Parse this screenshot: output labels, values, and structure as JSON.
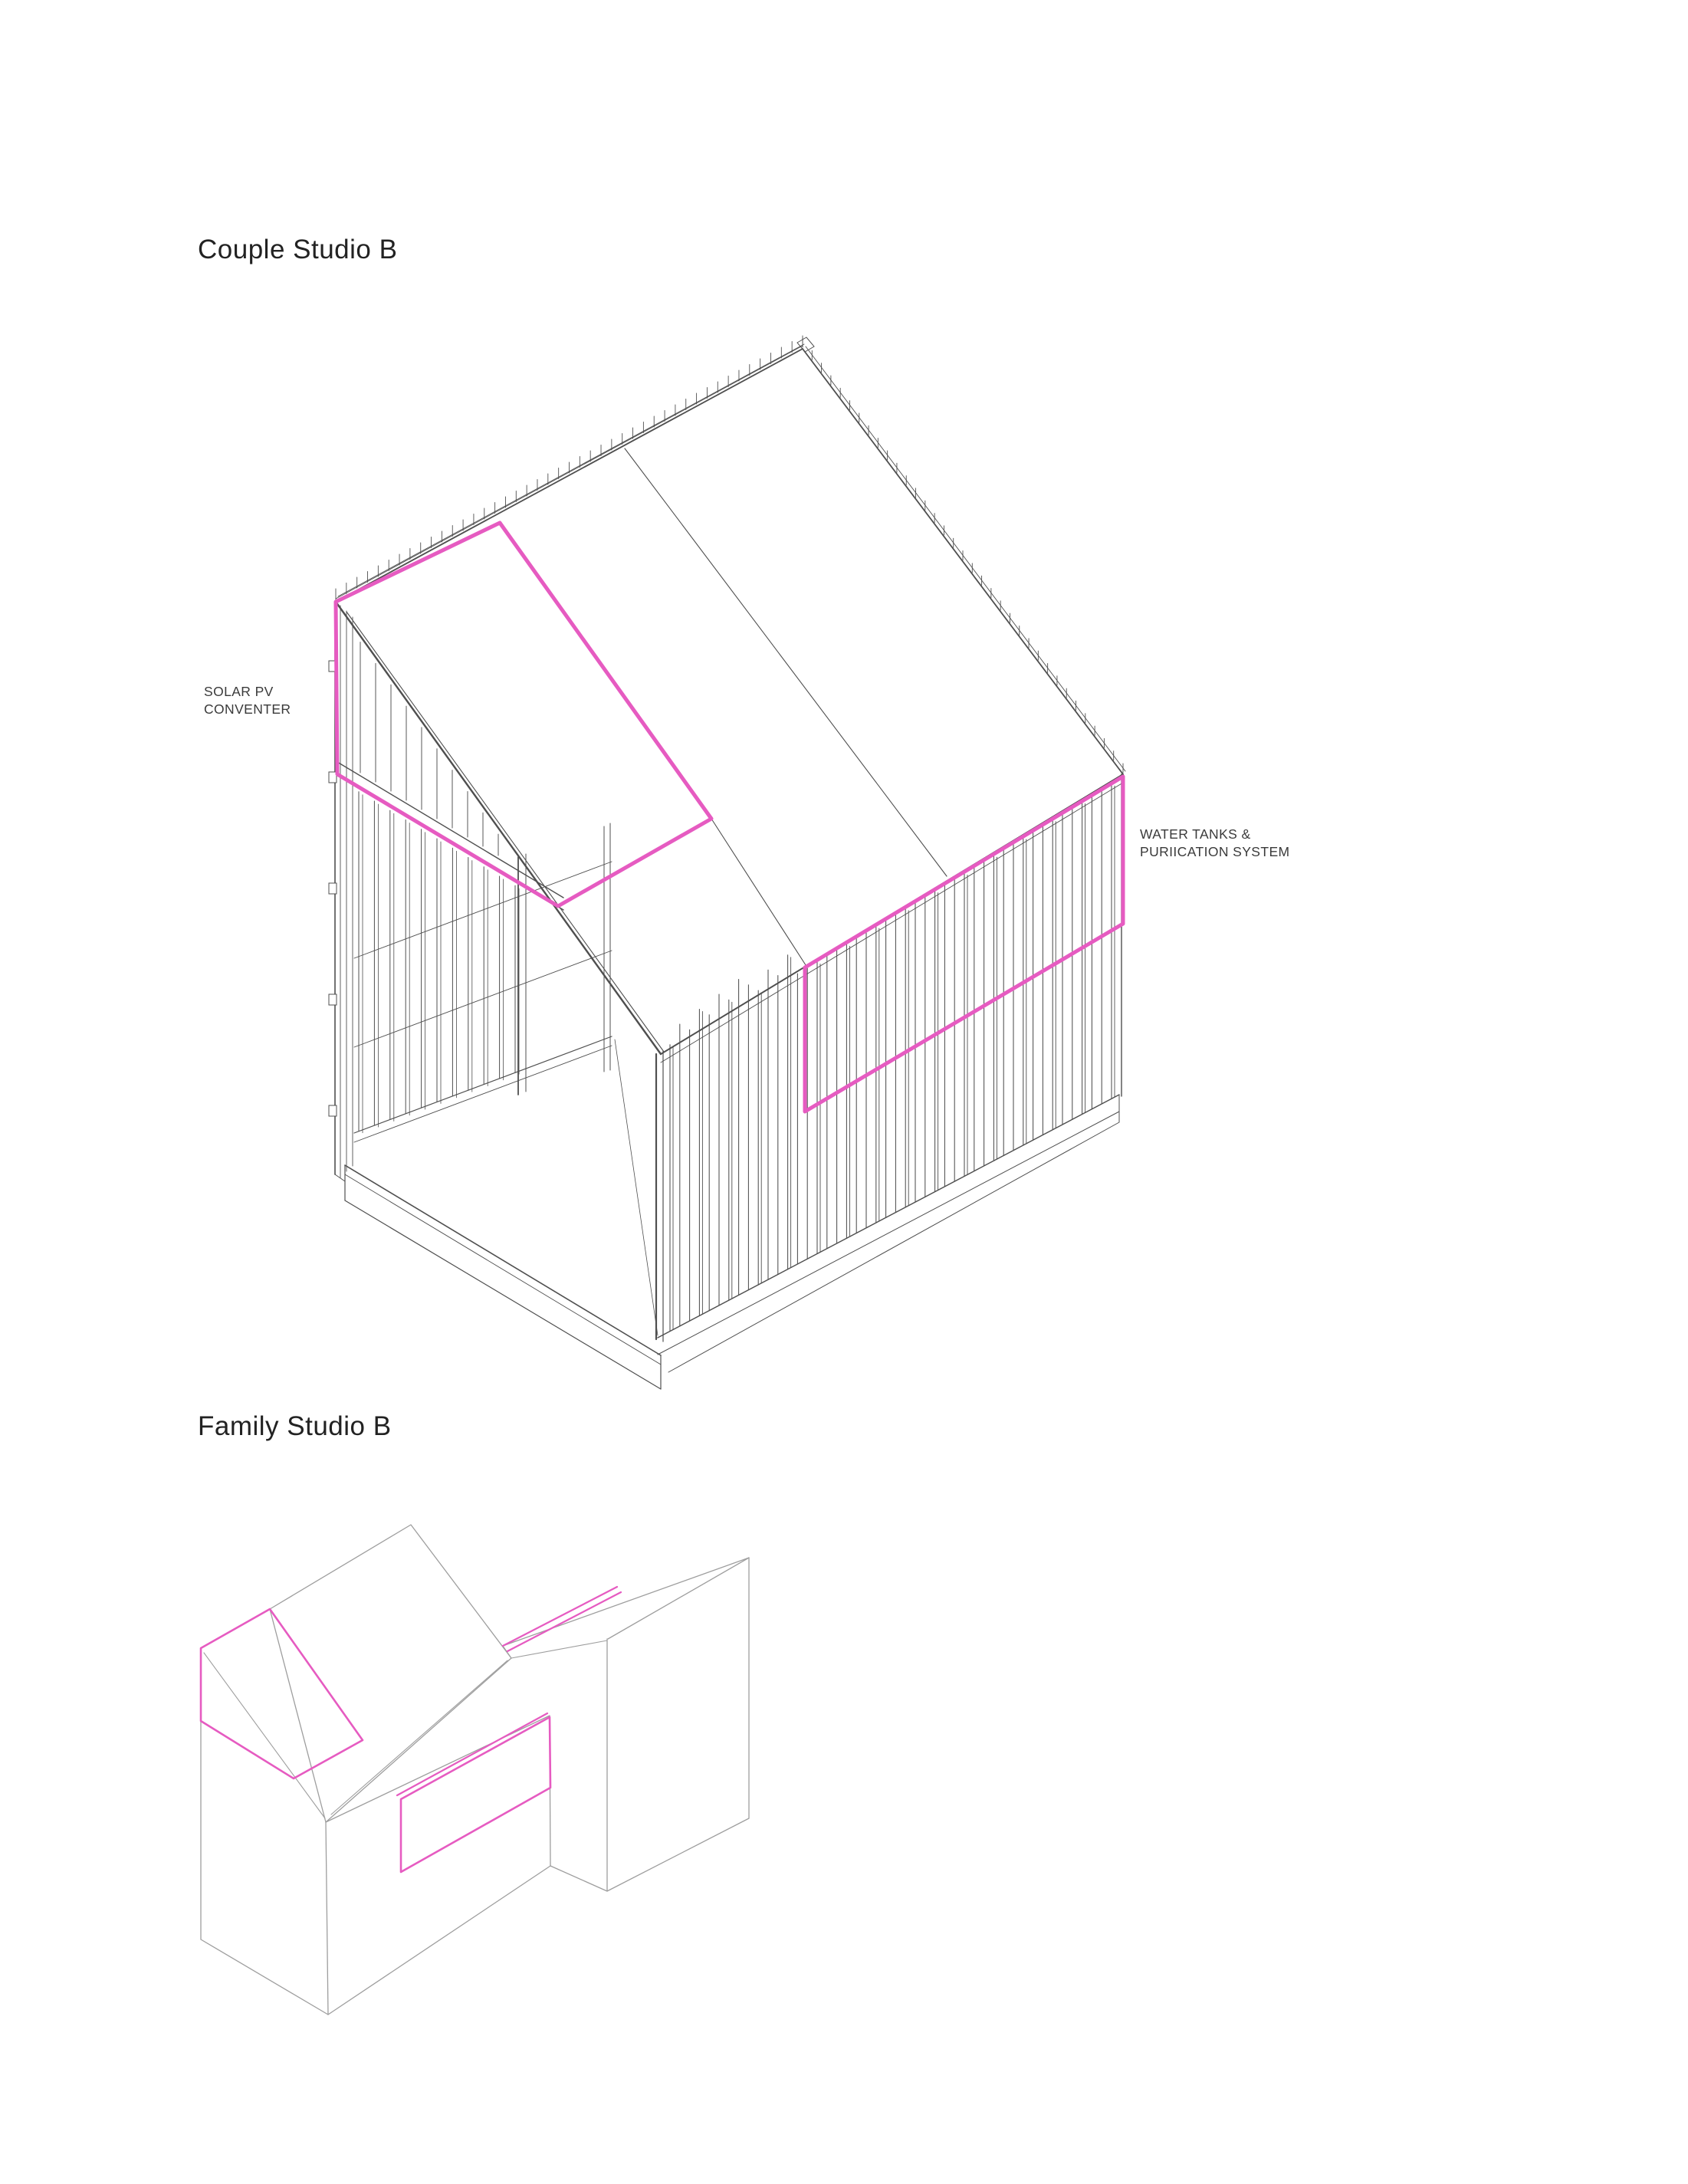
{
  "page": {
    "background": "#ffffff"
  },
  "sections": [
    {
      "id": "couple-studio-b",
      "title": "Couple Studio B"
    },
    {
      "id": "family-studio-b",
      "title": "Family Studio B"
    }
  ],
  "labels": {
    "solar_line1": "SOLAR PV",
    "solar_line2": "CONVENTER",
    "water_line1": "WATER TANKS &",
    "water_line2": "PURIICATION SYSTEM"
  },
  "colors": {
    "highlight": "#e65bc1",
    "line": "#4f4f4f",
    "line_light": "#9e9e9e",
    "text": "#222222"
  }
}
